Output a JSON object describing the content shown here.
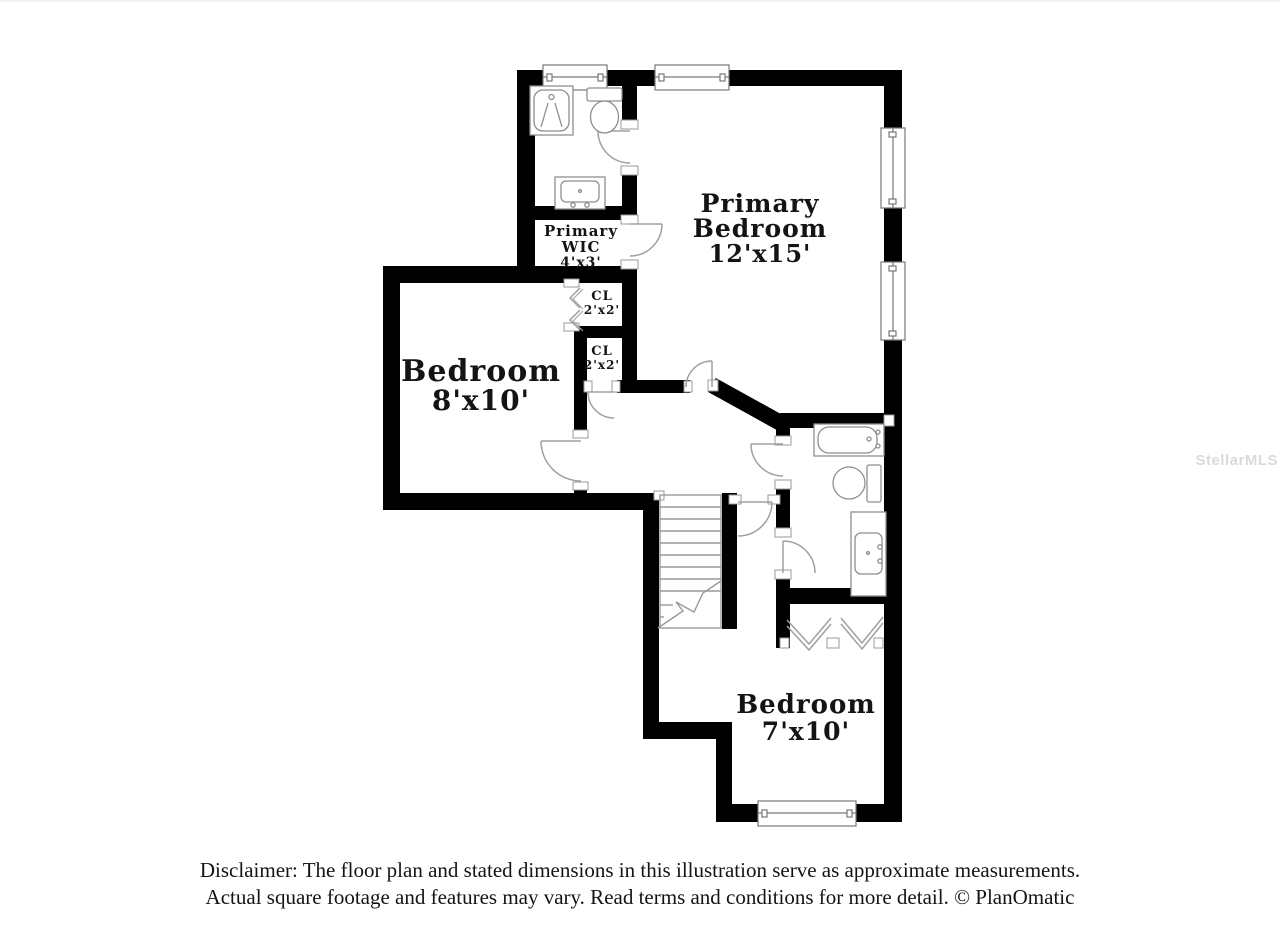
{
  "watermark": "StellarMLS",
  "disclaimer": {
    "line1": "Disclaimer: The floor plan and stated dimensions in this illustration serve as approximate measurements.",
    "line2": "Actual square footage and features may vary. Read terms and conditions for more detail. © PlanOmatic"
  },
  "floor_plan": {
    "rooms": [
      {
        "id": "primary-bedroom",
        "name": "Primary Bedroom",
        "dimensions": "12'x15'",
        "label_lines": [
          "Primary",
          "Bedroom"
        ]
      },
      {
        "id": "primary-wic",
        "name": "Primary WIC",
        "dimensions": "4'x3'",
        "label_lines": [
          "Primary",
          "WIC"
        ]
      },
      {
        "id": "closet-upper",
        "name": "CL",
        "dimensions": "2'x2'",
        "label_lines": [
          "CL"
        ]
      },
      {
        "id": "closet-lower",
        "name": "CL",
        "dimensions": "2'x2'",
        "label_lines": [
          "CL"
        ]
      },
      {
        "id": "bedroom-8x10",
        "name": "Bedroom",
        "dimensions": "8'x10'",
        "label_lines": [
          "Bedroom"
        ]
      },
      {
        "id": "bedroom-7x10",
        "name": "Bedroom",
        "dimensions": "7'x10'",
        "label_lines": [
          "Bedroom"
        ]
      }
    ],
    "fixtures": [
      "shower",
      "toilet",
      "vanity-sink",
      "bathtub",
      "toilet",
      "vanity-sink",
      "stairs",
      "bifold-closet-doors"
    ],
    "window_count": 5,
    "colors": {
      "wall": "#000000",
      "background": "#ffffff",
      "fixture_line": "#8e8e8e",
      "label_text": "#141414",
      "watermark": "#dadada"
    }
  }
}
